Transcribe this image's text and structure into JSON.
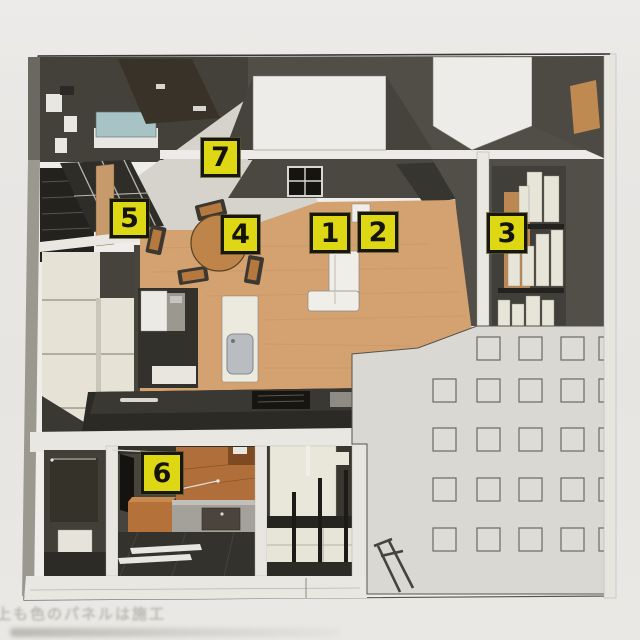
{
  "document": {
    "kind": "printed-page-scan",
    "subject": "3D cutaway floor plan rendering of an apartment with numbered callouts",
    "caption_faint_line1": "上も色のパネルは施工"
  },
  "markers": [
    {
      "number": "1"
    },
    {
      "number": "2"
    },
    {
      "number": "3"
    },
    {
      "number": "4"
    },
    {
      "number": "5"
    },
    {
      "number": "6"
    },
    {
      "number": "7"
    }
  ],
  "colors": {
    "marker_yellow": "#ded714",
    "marker_border": "#17160f",
    "wall_dark_gray": "#504e47",
    "wood_floor": "#d4a171",
    "wood_furniture": "#bf8449",
    "entry_floor_gray": "#d6d3cc",
    "teal_counter": "#a7c3c5",
    "cream_furniture": "#e7e5d8",
    "grid_wall_bg": "#dad8d3",
    "grid_line": "#6b6961",
    "page_background": "#e8e6e3"
  }
}
